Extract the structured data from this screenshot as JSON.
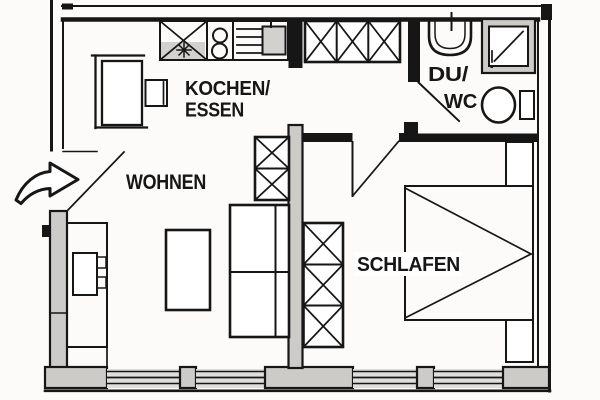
{
  "rooms": [
    {
      "name": "kitchen-dining",
      "label_line1": "KOCHEN/",
      "label_line2": "ESSEN"
    },
    {
      "name": "living-room",
      "label": "WOHNEN"
    },
    {
      "name": "shower-wc",
      "label_line1": "DU/",
      "label_line2": "WC"
    },
    {
      "name": "bedroom",
      "label": "SCHLAFEN"
    }
  ],
  "icons": {
    "entrance-arrow": "hollow curved arrow pointing right (➔) into entry door",
    "door-swing": "diagonal leaf line",
    "wardrobe-cell": "box with X cross",
    "hob-burners": "two circles",
    "sink-drain-star": "asterisk ✳"
  },
  "colors": {
    "line": "#161616",
    "wall-fill": "#cccbc7",
    "appliance-fill": "#d2d1ce",
    "glass-fill": "#dededb",
    "paper": "#fcfbf9"
  }
}
